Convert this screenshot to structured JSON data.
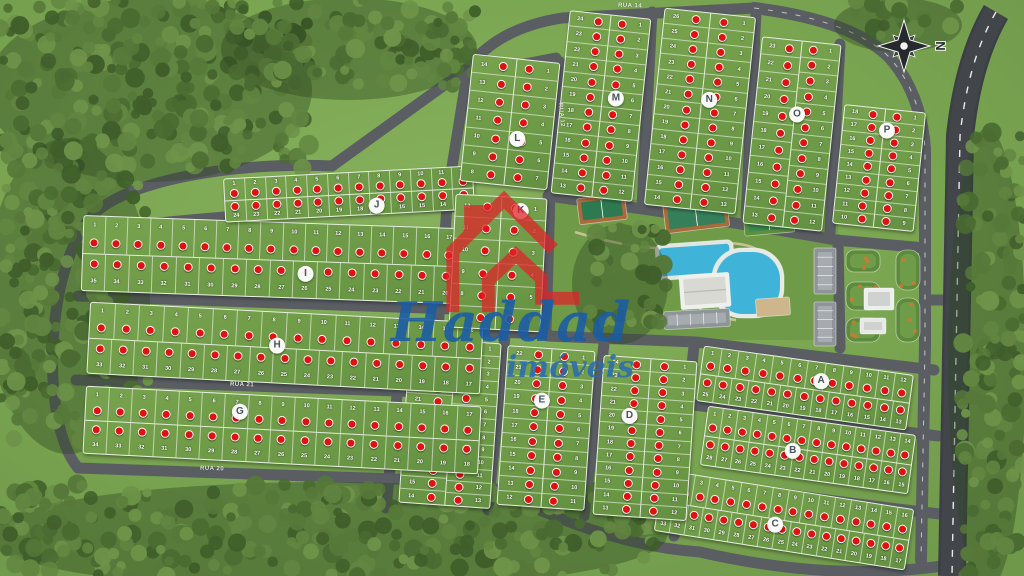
{
  "map": {
    "watermark": {
      "line1": "Haddad",
      "line2": "imóveis"
    },
    "compass": {
      "label": "N"
    },
    "colors": {
      "sold_marker": "#e01111",
      "road": "#5a5e62",
      "highway": "#42464b",
      "lawn": "#7ca452",
      "block_grass": "#6b9845",
      "forest": "#4a6b31",
      "watermark_red": "#e02329",
      "watermark_blue": "#1a5ca6",
      "pool_water": "#3fb4d8",
      "court_surround": "#a96a3c"
    },
    "street_labels": [
      {
        "name": "RUA 14",
        "x": 618,
        "y": 3,
        "rot": 2
      },
      {
        "name": "RUA 12",
        "x": 549,
        "y": 112,
        "rot": 85
      },
      {
        "name": "RUA 21",
        "x": 230,
        "y": 382,
        "rot": 2
      },
      {
        "name": "RUA 20",
        "x": 200,
        "y": 466,
        "rot": 2
      }
    ],
    "blocks": [
      {
        "letter": "A",
        "o": "h",
        "x": 699,
        "y": 360,
        "w": 212,
        "h": 56,
        "t": 8,
        "lx": 57,
        "ly": 34,
        "s1": [
          1,
          2,
          3,
          4,
          5,
          6,
          7,
          8,
          9,
          10,
          11,
          12
        ],
        "s2": [
          25,
          24,
          23,
          22,
          21,
          20,
          19,
          18,
          17,
          16,
          15,
          14,
          13
        ]
      },
      {
        "letter": "B",
        "o": "h",
        "x": 703,
        "y": 420,
        "w": 210,
        "h": 60,
        "t": 8,
        "lx": 43,
        "ly": 55,
        "s1": [
          1,
          2,
          3,
          4,
          5,
          6,
          7,
          8,
          9,
          10,
          11,
          12,
          13,
          14
        ],
        "s2": [
          28,
          27,
          26,
          25,
          24,
          23,
          22,
          21,
          20,
          19,
          18,
          17,
          16,
          15
        ]
      },
      {
        "letter": "C",
        "o": "h",
        "x": 657,
        "y": 489,
        "w": 254,
        "h": 62,
        "t": 9,
        "lx": 47,
        "ly": 60,
        "s1": [
          1,
          2,
          3,
          4,
          5,
          6,
          7,
          8,
          9,
          10,
          11,
          12,
          13,
          14,
          15,
          16
        ],
        "s2": [
          33,
          32,
          31,
          30,
          29,
          28,
          27,
          26,
          25,
          24,
          23,
          22,
          21,
          20,
          19,
          18,
          17
        ]
      },
      {
        "letter": "D",
        "o": "v",
        "x": 598,
        "y": 358,
        "w": 94,
        "h": 160,
        "t": 4,
        "lx": 31,
        "ly": 37,
        "s1": [
          24,
          23,
          22,
          21,
          20,
          19,
          18,
          17,
          16,
          15,
          14,
          13
        ],
        "s2": [
          1,
          2,
          3,
          4,
          5,
          6,
          7,
          8,
          9,
          10,
          11,
          12
        ]
      },
      {
        "letter": "E",
        "o": "v",
        "x": 502,
        "y": 348,
        "w": 88,
        "h": 160,
        "t": 4,
        "lx": 43,
        "ly": 33,
        "s1": [
          22,
          21,
          20,
          19,
          18,
          17,
          16,
          15,
          14,
          13,
          12
        ],
        "s2": [
          1,
          2,
          3,
          4,
          5,
          6,
          7,
          8,
          9,
          10,
          11
        ]
      },
      {
        "letter": "F",
        "o": "v",
        "x": 404,
        "y": 340,
        "w": 92,
        "h": 166,
        "t": 4,
        "lx": 53,
        "ly": 26,
        "s1": [
          25,
          24,
          23,
          22,
          21,
          20,
          19,
          18,
          17,
          16,
          15,
          14
        ],
        "s2": [
          1,
          2,
          3,
          4,
          5,
          6,
          7,
          8,
          9,
          10,
          11,
          12,
          13
        ]
      },
      {
        "letter": "G",
        "o": "h",
        "x": 84,
        "y": 396,
        "w": 396,
        "h": 68,
        "t": 3,
        "lx": 39,
        "ly": 25,
        "s1": [
          1,
          2,
          3,
          4,
          5,
          6,
          7,
          8,
          9,
          10,
          11,
          12,
          13,
          14,
          15,
          16,
          17
        ],
        "s2": [
          34,
          33,
          32,
          31,
          30,
          29,
          28,
          27,
          26,
          25,
          24,
          23,
          22,
          21,
          20,
          19,
          18
        ]
      },
      {
        "letter": "H",
        "o": "h",
        "x": 88,
        "y": 312,
        "w": 394,
        "h": 72,
        "t": 3,
        "lx": 48,
        "ly": 47,
        "s1": [
          1,
          2,
          3,
          4,
          5,
          6,
          7,
          8,
          9,
          10,
          11,
          12,
          13,
          14,
          15,
          16
        ],
        "s2": [
          33,
          32,
          31,
          30,
          29,
          28,
          27,
          26,
          25,
          24,
          23,
          22,
          21,
          20,
          19,
          18,
          17
        ]
      },
      {
        "letter": "I",
        "o": "h",
        "x": 82,
        "y": 222,
        "w": 400,
        "h": 76,
        "t": 2,
        "lx": 56,
        "ly": 67,
        "s1": [
          1,
          2,
          3,
          4,
          5,
          6,
          7,
          8,
          9,
          10,
          11,
          12,
          13,
          14,
          15,
          16,
          17,
          18
        ],
        "s2": [
          35,
          34,
          33,
          32,
          31,
          30,
          29,
          28,
          27,
          26,
          25,
          24,
          23,
          22,
          21,
          20,
          19
        ]
      },
      {
        "letter": "J",
        "o": "h",
        "x": 224,
        "y": 172,
        "w": 250,
        "h": 44,
        "t": -3,
        "lx": 61,
        "ly": 80,
        "s1": [
          1,
          2,
          3,
          4,
          5,
          6,
          7,
          8,
          9,
          10,
          11,
          12
        ],
        "s2": [
          24,
          23,
          22,
          21,
          20,
          19,
          18,
          17,
          16,
          15,
          14,
          13
        ]
      },
      {
        "letter": "K",
        "o": "v",
        "x": 452,
        "y": 196,
        "w": 92,
        "h": 134,
        "t": 3,
        "lx": 72,
        "ly": 10,
        "s1": [
          12,
          11,
          10,
          9,
          8,
          7
        ],
        "s2": [
          1,
          2,
          3,
          4,
          5,
          6
        ]
      },
      {
        "letter": "L",
        "o": "v",
        "x": 466,
        "y": 58,
        "w": 88,
        "h": 128,
        "t": 6,
        "lx": 61,
        "ly": 63,
        "s1": [
          14,
          13,
          12,
          11,
          10,
          9,
          8
        ],
        "s2": [
          1,
          2,
          3,
          4,
          5,
          6,
          7
        ]
      },
      {
        "letter": "M",
        "o": "v",
        "x": 560,
        "y": 14,
        "w": 82,
        "h": 184,
        "t": 6,
        "lx": 67,
        "ly": 45,
        "s1": [
          24,
          23,
          22,
          21,
          20,
          19,
          18,
          17,
          16,
          15,
          14,
          13
        ],
        "s2": [
          1,
          2,
          3,
          4,
          5,
          6,
          7,
          8,
          9,
          10,
          11,
          12
        ]
      },
      {
        "letter": "N",
        "o": "v",
        "x": 654,
        "y": 12,
        "w": 92,
        "h": 198,
        "t": 6,
        "lx": 59,
        "ly": 44,
        "s1": [
          26,
          25,
          24,
          23,
          22,
          21,
          20,
          19,
          18,
          17,
          16,
          15,
          14
        ],
        "s2": [
          1,
          2,
          3,
          4,
          5,
          6,
          7,
          8,
          9,
          10,
          11,
          12,
          13
        ]
      },
      {
        "letter": "O",
        "o": "v",
        "x": 752,
        "y": 40,
        "w": 80,
        "h": 188,
        "t": 6,
        "lx": 54,
        "ly": 39,
        "s1": [
          23,
          22,
          21,
          20,
          19,
          18,
          17,
          16,
          15,
          14,
          13
        ],
        "s2": [
          1,
          2,
          3,
          4,
          5,
          6,
          7,
          8,
          9,
          10,
          11,
          12
        ]
      },
      {
        "letter": "P",
        "o": "v",
        "x": 838,
        "y": 108,
        "w": 82,
        "h": 120,
        "t": 6,
        "lx": 55,
        "ly": 18,
        "s1": [
          18,
          17,
          16,
          15,
          14,
          13,
          12,
          11,
          10
        ],
        "s2": [
          1,
          2,
          3,
          4,
          5,
          6,
          7,
          8,
          9
        ]
      }
    ],
    "layout": {
      "roads": [
        "M 78 468 L 482 482",
        "M 482 482 Q 600 545 700 552 Q 830 582 942 566",
        "M 76 380 L 482 394",
        "M 78 296 L 482 310",
        "M 150 224 Q 300 208 482 206",
        "M 78 468 C 38 420 46 258 96 212 C 132 180 232 162 332 166",
        "M 332 166 L 468 68",
        "M 468 68 Q 498 28 562 18 L 754 8",
        "M 468 68 L 448 192 L 438 330",
        "M 438 330 L 548 334",
        "M 550 192 L 546 334",
        "M 548 196 Q 700 216 836 240",
        "M 836 240 L 925 248",
        "M 462 76 L 556 58",
        "M 560 62 L 550 190",
        "M 652 12 L 642 206",
        "M 756 12 L 746 216",
        "M 840 44 L 830 232",
        "M 403 334 L 386 508",
        "M 505 336 L 488 510",
        "M 604 344 L 584 516",
        "M 694 346 L 674 536",
        "M 548 336 L 696 342 L 934 370",
        "M 686 404 L 938 436",
        "M 680 478 Q 800 498 940 514",
        "M 925 300 L 954 300",
        "M 838 240 L 840 348"
      ],
      "avenue": "M 754 8 Q 850 20 888 56 Q 920 90 925 148 L 925 345 L 921 560",
      "highway": "M 996 12 Q 968 60 960 136 L 952 576",
      "walkways": [
        "M 575 232 Q 650 255 700 246 Q 740 238 762 252",
        "M 640 322 Q 690 312 736 320",
        "M 700 246 Q 706 280 700 312"
      ],
      "club_base": {
        "x": 552,
        "y": 200,
        "w": 286,
        "h": 140
      },
      "amenities": [
        {
          "name": "tennis-court",
          "x": 578,
          "y": 196,
          "w": 48,
          "h": 26,
          "rot": -7,
          "fill": "#a96a3c",
          "inner": "#2e7a50"
        },
        {
          "name": "multi-sport-court",
          "x": 664,
          "y": 198,
          "w": 64,
          "h": 32,
          "rot": -7,
          "fill": "#a96a3c",
          "inner": "#35805a"
        },
        {
          "name": "soccer-court",
          "x": 744,
          "y": 212,
          "w": 50,
          "h": 22,
          "rot": -5,
          "fill": "#5d8f3f",
          "inner": "#3b8a4e"
        },
        {
          "name": "pool-deck",
          "x": 656,
          "y": 242,
          "w": 78,
          "h": 36,
          "rot": -4,
          "rx": 6,
          "fill": "#e2e6e3",
          "inner": "#3fb4d8"
        },
        {
          "name": "lagoon-pool",
          "x": 712,
          "y": 248,
          "w": 72,
          "h": 70,
          "rot": 0,
          "rx": 30,
          "fill": "#e6e9e4",
          "inner": "#3fb4d8"
        },
        {
          "name": "clubhouse",
          "x": 680,
          "y": 274,
          "w": 50,
          "h": 34,
          "rot": -4,
          "rx": 2,
          "fill": "#eef0ec",
          "inner": "#d7d9d2"
        },
        {
          "name": "patio",
          "x": 756,
          "y": 298,
          "w": 34,
          "h": 18,
          "rot": -4,
          "fill": "#cdb68b"
        },
        {
          "name": "parking-lot",
          "x": 664,
          "y": 310,
          "w": 66,
          "h": 18,
          "rot": -3,
          "fill": "#8f9499",
          "inner": "#a6abb0"
        },
        {
          "name": "parking-strip",
          "x": 814,
          "y": 248,
          "w": 22,
          "h": 46,
          "rot": 0,
          "fill": "#8f9499",
          "inner": "#a6abb0"
        },
        {
          "name": "parking-strip",
          "x": 814,
          "y": 302,
          "w": 22,
          "h": 44,
          "rot": 0,
          "fill": "#8f9499",
          "inner": "#a6abb0"
        },
        {
          "name": "garden-bed",
          "x": 846,
          "y": 250,
          "w": 34,
          "h": 22,
          "rot": 0,
          "rx": 8,
          "fill": "#5d8b3d",
          "inner": "#6f9c48"
        },
        {
          "name": "garden-bed",
          "x": 896,
          "y": 250,
          "w": 24,
          "h": 40,
          "rot": 0,
          "rx": 10,
          "fill": "#5d8b3d",
          "inner": "#6f9c48"
        },
        {
          "name": "garden-bed",
          "x": 846,
          "y": 282,
          "w": 34,
          "h": 28,
          "rot": 0,
          "rx": 9,
          "fill": "#5d8b3d",
          "inner": "#6f9c48"
        },
        {
          "name": "garden-bed",
          "x": 896,
          "y": 298,
          "w": 24,
          "h": 44,
          "rot": 0,
          "rx": 10,
          "fill": "#5d8b3d",
          "inner": "#6f9c48"
        },
        {
          "name": "garden-bed",
          "x": 846,
          "y": 318,
          "w": 34,
          "h": 24,
          "rot": 0,
          "rx": 9,
          "fill": "#5d8b3d",
          "inner": "#6f9c48"
        },
        {
          "name": "gatehouse",
          "x": 864,
          "y": 288,
          "w": 30,
          "h": 22,
          "rot": 0,
          "rx": 2,
          "fill": "#edefed",
          "inner": "#cfd2cf"
        },
        {
          "name": "gatehouse",
          "x": 860,
          "y": 318,
          "w": 26,
          "h": 16,
          "rot": 0,
          "rx": 2,
          "fill": "#e7e9e7",
          "inner": "#cfd2cf"
        }
      ],
      "forest_zones": [
        {
          "x": 0,
          "y": 0,
          "w": 310,
          "h": 168
        },
        {
          "x": 235,
          "y": 0,
          "w": 240,
          "h": 86
        },
        {
          "x": 0,
          "y": 140,
          "w": 148,
          "h": 300
        },
        {
          "x": 0,
          "y": 484,
          "w": 665,
          "h": 92
        },
        {
          "x": 962,
          "y": 130,
          "w": 62,
          "h": 446
        },
        {
          "x": 848,
          "y": 0,
          "w": 112,
          "h": 38
        },
        {
          "x": 586,
          "y": 226,
          "w": 80,
          "h": 104
        }
      ]
    }
  }
}
